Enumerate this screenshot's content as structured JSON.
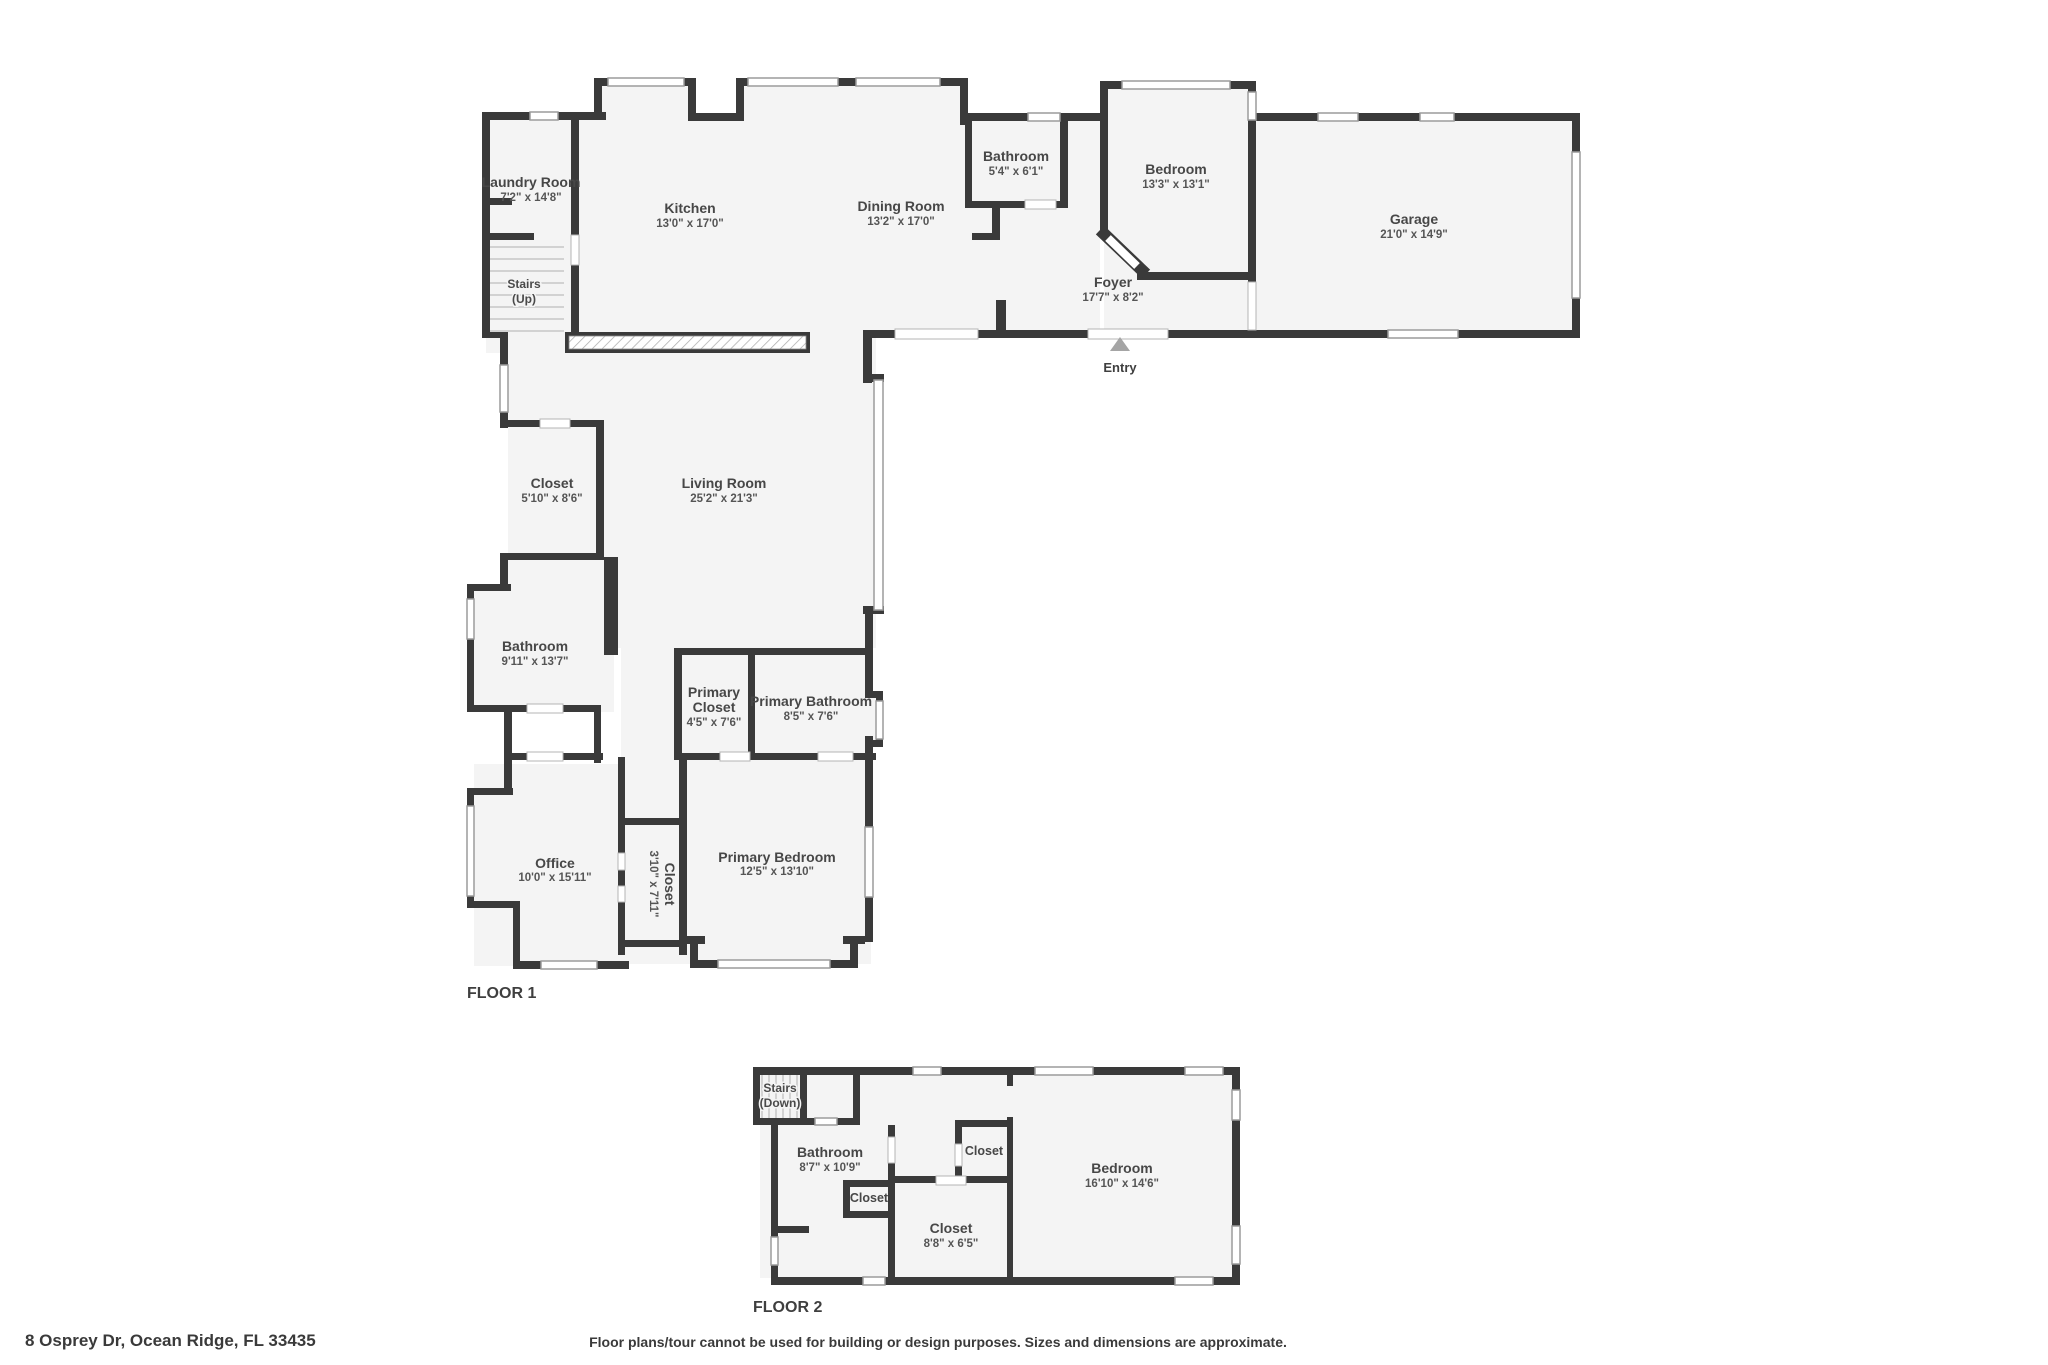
{
  "colors": {
    "wall": "#3a3a3a",
    "floor": "#f4f4f4",
    "window_stroke": "#9b9b9b",
    "entry_marker": "#a5a5a5"
  },
  "f1": {
    "label": "FLOOR 1",
    "laundry_name": "Laundry Room",
    "laundry_dims": "7'2\" x 14'8\"",
    "stairs1": "Stairs",
    "stairs2": "(Up)",
    "kitchen_name": "Kitchen",
    "kitchen_dims": "13'0\" x 17'0\"",
    "dining_name": "Dining Room",
    "dining_dims": "13'2\" x 17'0\"",
    "bath_top_name": "Bathroom",
    "bath_top_dims": "5'4\" x 6'1\"",
    "bedroom_name": "Bedroom",
    "bedroom_dims": "13'3\" x 13'1\"",
    "foyer_name": "Foyer",
    "foyer_dims": "17'7\" x 8'2\"",
    "garage_name": "Garage",
    "garage_dims": "21'0\" x 14'9\"",
    "entry": "Entry",
    "closet_name": "Closet",
    "closet_dims": "5'10\" x 8'6\"",
    "living_name": "Living Room",
    "living_dims": "25'2\" x 21'3\"",
    "bath_left_name": "Bathroom",
    "bath_left_dims": "9'11\" x 13'7\"",
    "pcloset1": "Primary",
    "pcloset2": "Closet",
    "pcloset_dims": "4'5\" x 7'6\"",
    "pbath_name": "Primary Bathroom",
    "pbath_dims": "8'5\" x 7'6\"",
    "office_name": "Office",
    "office_dims": "10'0\" x 15'11\"",
    "closetv_name": "Closet",
    "closetv_dims": "3'10\" x 7'11\"",
    "pbed_name": "Primary Bedroom",
    "pbed_dims": "12'5\" x 13'10\""
  },
  "f2": {
    "label": "FLOOR 2",
    "stairs1": "Stairs",
    "stairs2": "(Down)",
    "bath_name": "Bathroom",
    "bath_dims": "8'7\" x 10'9\"",
    "closet_top": "Closet",
    "closet_left": "Closet",
    "closet_main_name": "Closet",
    "closet_main_dims": "8'8\" x 6'5\"",
    "bedroom_name": "Bedroom",
    "bedroom_dims": "16'10\" x 14'6\""
  },
  "footer": {
    "address": "8 Osprey Dr, Ocean Ridge, FL 33435",
    "disclaimer": "Floor plans/tour cannot be used for building or design purposes. Sizes and dimensions are approximate."
  }
}
